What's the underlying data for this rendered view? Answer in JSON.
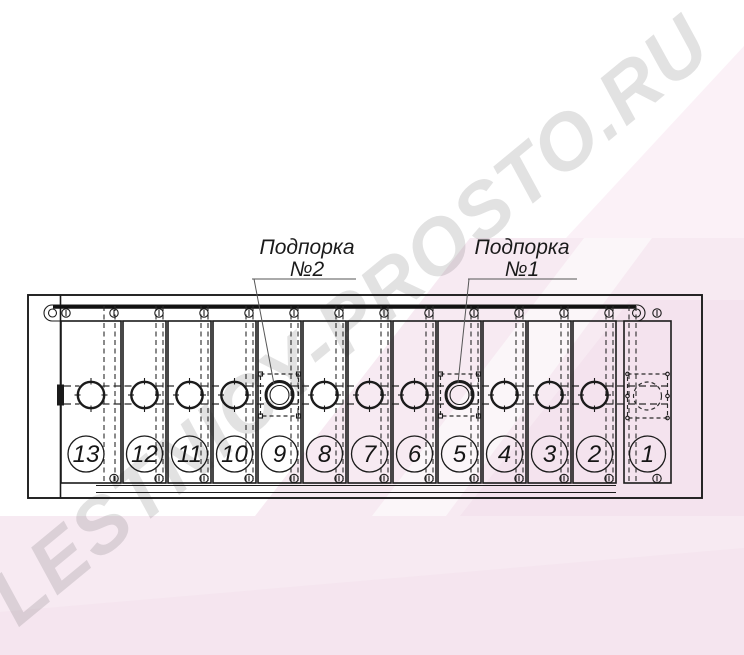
{
  "watermark": {
    "text": "LESTNICY-PROSTO.RU"
  },
  "annotations": {
    "support2": {
      "name": "Подпорка",
      "number": "№2",
      "target_panel": "9"
    },
    "support1": {
      "name": "Подпорка",
      "number": "№1",
      "target_panel": "5"
    }
  },
  "drawing": {
    "panel_numbers": [
      "13",
      "12",
      "11",
      "10",
      "9",
      "8",
      "7",
      "6",
      "5",
      "4",
      "3",
      "2",
      "1"
    ],
    "support_panels": [
      "9",
      "5"
    ],
    "hidden_hole_panel": "1"
  },
  "colors": {
    "line": "#1b1b1b",
    "watermark_gray": "#e3e3e3",
    "pink_light": "#f7eaf2",
    "pink_pale": "#fbf1f7",
    "pink_deep": "#f1dbe9"
  }
}
